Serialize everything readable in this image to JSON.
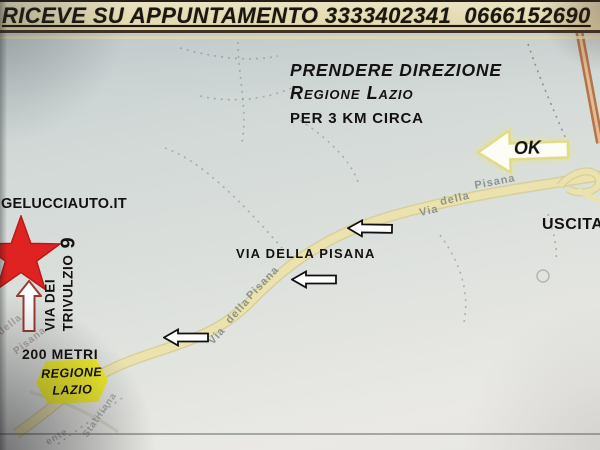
{
  "banner": {
    "text": "RICEVE SU APPUNTAMENTO 3333402341  0666152690"
  },
  "directions": {
    "line1": "PRENDERE DIREZIONE",
    "line2": "Regione Lazio",
    "line3": "PER 3 KM CIRCA"
  },
  "ok_arrow": {
    "label": "OK"
  },
  "exit": {
    "label": "USCITA"
  },
  "website": {
    "label": "GELUCCIAUTO.IT"
  },
  "destination": {
    "street_line1": "VIA DEI",
    "street_line2": "TRIVULZIO",
    "street_number": "9",
    "distance": "200 METRI"
  },
  "region_sign": {
    "line1": "REGIONE",
    "line2": "LAZIO"
  },
  "road_annotation": {
    "label": "VIA DELLA PISANA"
  },
  "map_labels": {
    "upper": [
      "Via",
      "della",
      "Pisana"
    ],
    "mid": [
      "Via",
      "della",
      "Pisana"
    ],
    "lower": [
      "della",
      "Pisana"
    ],
    "bottom": [
      "ente",
      "Statiliana"
    ]
  },
  "colors": {
    "banner_bg": "#f1e7b8",
    "star_red": "#df2323",
    "sign_yellow": "#f2ee2c",
    "road_yellow": "#eae1ab",
    "highway_orange": "#b5744a",
    "map_bg": "#d7dcd9"
  }
}
